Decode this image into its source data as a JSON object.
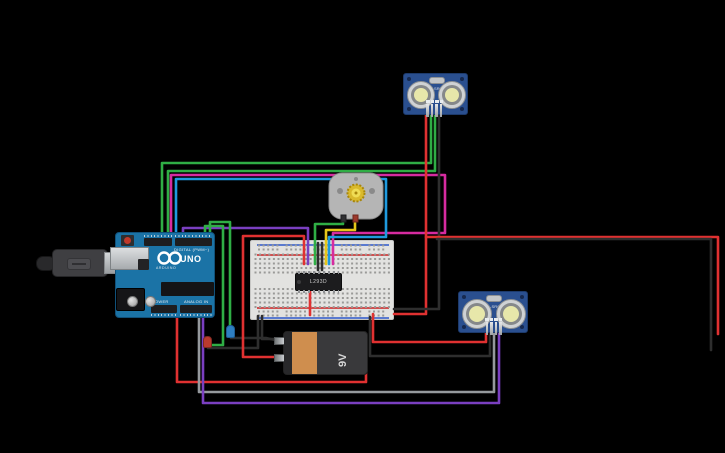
{
  "canvas": {
    "width": 725,
    "height": 453,
    "background": "#000000"
  },
  "palette": {
    "green": "#2fae45",
    "pink": "#d62ba0",
    "blue": "#1e9ade",
    "purple": "#7a3fc0",
    "yellow": "#e6c619",
    "red": "#e03131",
    "black": "#2e2e2e",
    "gray": "#95999d",
    "board_blue": "#1b73a6",
    "sensor_pcb": "#2a4f8f",
    "battery_orange": "#cf8e4e"
  },
  "components": {
    "arduino": {
      "name": "Arduino Uno R3",
      "logo_text": "ARDUINO",
      "model_label": "UNO",
      "digital_label": "DIGITAL (PWM~)",
      "power_label": "POWER",
      "analog_label": "ANALOG IN"
    },
    "usb_cable": {
      "name": "USB cable"
    },
    "breadboard": {
      "name": "Small breadboard"
    },
    "ic_chip": {
      "label": "L293D",
      "name": "Motor driver IC"
    },
    "battery": {
      "label": "9V",
      "name": "9V battery"
    },
    "motor": {
      "name": "DC gearmotor"
    },
    "sensor_top": {
      "label": "HC-SR04",
      "name": "Ultrasonic distance sensor"
    },
    "sensor_bottom": {
      "label": "HC-SR04",
      "name": "Ultrasonic distance sensor"
    },
    "led_red": {
      "name": "Red LED",
      "color": "#b93a2e"
    },
    "led_blue": {
      "name": "Blue LED",
      "color": "#2e7fc2"
    }
  },
  "wires": [
    {
      "name": "wire-green-sensor1-trig",
      "color": "green",
      "points": "162,240 162,163 431,163 431,112"
    },
    {
      "name": "wire-green-sensor1-echo",
      "color": "green",
      "points": "168,240 168,171 435,171 435,112"
    },
    {
      "name": "wire-pink-uno-breadboard",
      "color": "pink",
      "points": "171,240 171,175 445,175 445,233 333,233 333,264"
    },
    {
      "name": "wire-blue-uno-breadboard",
      "color": "blue",
      "points": "176,240 176,179 386,179 386,237 329,237 329,264"
    },
    {
      "name": "wire-purple-uno-breadboard",
      "color": "purple",
      "points": "183,240 183,228 308,228 308,264"
    },
    {
      "name": "wire-green-uno-led-blue",
      "color": "green",
      "points": "210,240 210,222 230,222 230,327"
    },
    {
      "name": "wire-green-uno-led-red",
      "color": "green",
      "points": "205,240 205,226 223,226 223,345 212,345"
    },
    {
      "name": "wire-black-led-red-breadboard",
      "color": "black",
      "points": "208,348 258,348 258,316"
    },
    {
      "name": "wire-black-led-blue-battery",
      "color": "black",
      "points": "231,338 266,338 275,340"
    },
    {
      "name": "wire-black-battery-breadboard",
      "color": "black",
      "points": "277,339 262,339 262,316"
    },
    {
      "name": "wire-red-breadboard-battery",
      "color": "red",
      "points": "304,264 304,236 243,236 243,357 276,357"
    },
    {
      "name": "wire-green-motor-breadboard",
      "color": "green",
      "points": "343,218 343,224 315,224 315,264"
    },
    {
      "name": "wire-yellow-motor-breadboard",
      "color": "yellow",
      "points": "355,218 355,230 326,230 326,264"
    },
    {
      "name": "wire-red-sensor1-vcc",
      "color": "red",
      "points": "426,112 426,314 394,314"
    },
    {
      "name": "wire-black-sensor1-gnd",
      "color": "black",
      "points": "439,112 439,309 394,309"
    },
    {
      "name": "wire-red-right-edge",
      "color": "red",
      "points": "426,237 718,237 718,334"
    },
    {
      "name": "wire-black-right-edge",
      "color": "black",
      "points": "437,239 711,239 711,350"
    },
    {
      "name": "wire-red-uno-bottom-loop",
      "color": "red",
      "points": "177,312 177,382 366,382 366,344"
    },
    {
      "name": "wire-red-sensor2-vcc",
      "color": "red",
      "points": "486,330 486,342 373,342 373,314"
    },
    {
      "name": "wire-black-sensor2-gnd",
      "color": "black",
      "points": "490,330 490,356 370,356 370,317"
    },
    {
      "name": "wire-gray-sensor2-trig",
      "color": "gray",
      "points": "494,330 494,392 199,392 199,310"
    },
    {
      "name": "wire-purple-sensor2-echo",
      "color": "purple",
      "points": "499,330 499,403 203,403 203,310"
    },
    {
      "name": "wire-black-bb-jumper-1",
      "color": "black",
      "points": "318,243 318,270"
    },
    {
      "name": "wire-black-bb-jumper-2",
      "color": "black",
      "points": "322,243 322,270"
    },
    {
      "name": "wire-red-bb-jumper",
      "color": "red",
      "points": "310,290 310,315"
    }
  ]
}
